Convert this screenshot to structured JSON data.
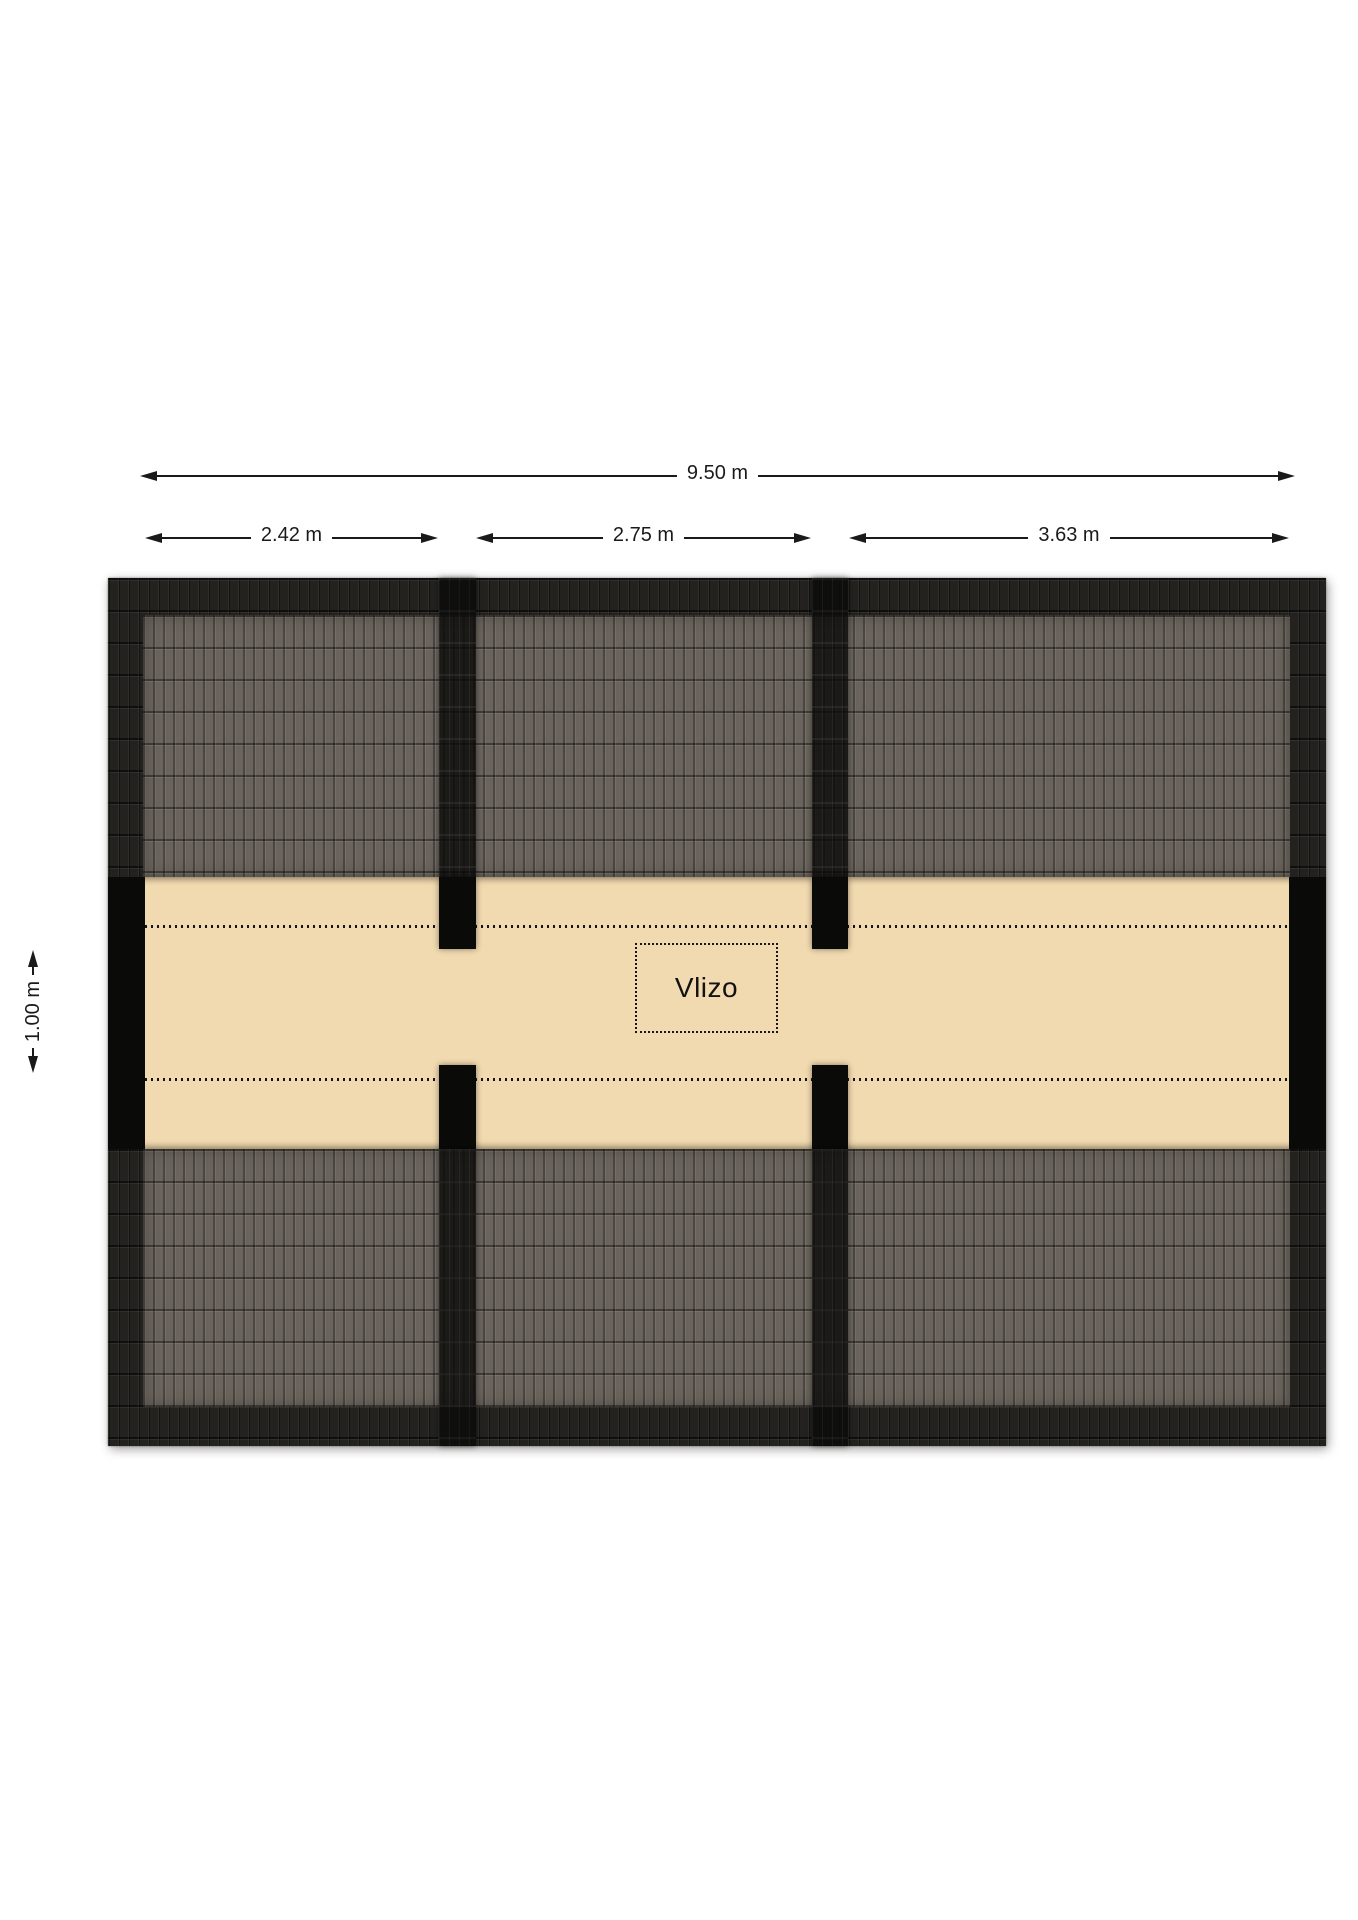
{
  "dimensions": {
    "total": {
      "label": "9.50 m"
    },
    "segments": [
      {
        "label": "2.42 m"
      },
      {
        "label": "2.75 m"
      },
      {
        "label": "3.63 m"
      }
    ],
    "vertical": {
      "label": "1.00 m"
    }
  },
  "plan": {
    "room_label": "Vlizo",
    "colors": {
      "floor": "#f2dab0",
      "roof_field": "#6a645c",
      "roof_edge": "#23221f",
      "wall": "#0a0a09",
      "dimension": "#1a1a1a"
    }
  }
}
